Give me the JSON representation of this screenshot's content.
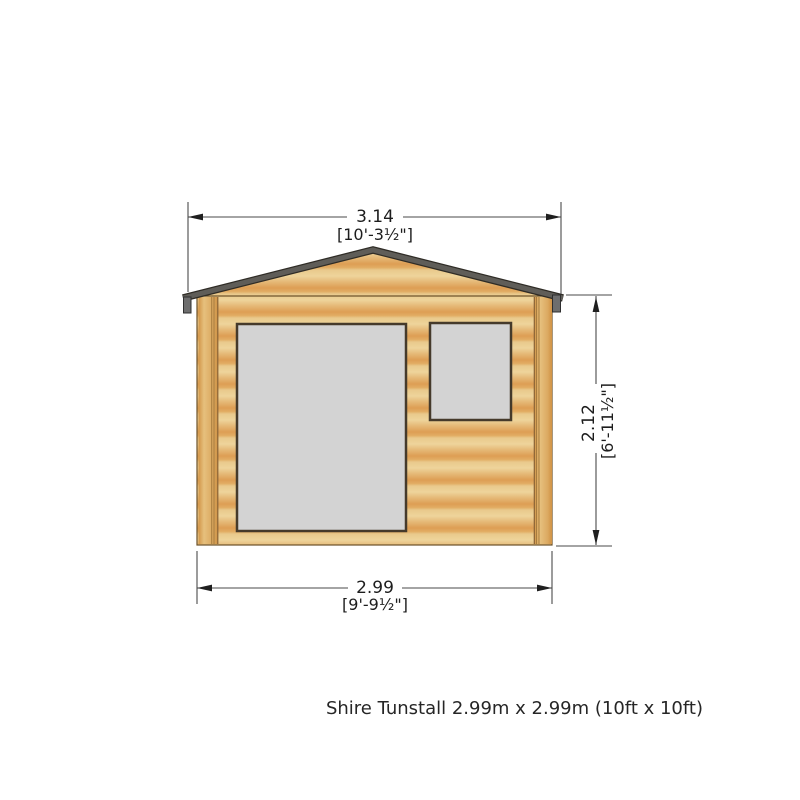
{
  "caption": "Shire Tunstall 2.99m x 2.99m (10ft x 10ft)",
  "product": {
    "name": "Shire Tunstall",
    "size_metric": "2.99m x 2.99m",
    "size_imperial": "10ft x 10ft",
    "view": "front elevation drawing",
    "features": [
      "gabled roof",
      "door",
      "window"
    ]
  },
  "dimensions": {
    "overall_width": {
      "metric": "3.14",
      "imperial": "[10'-3½\"]"
    },
    "wall_height": {
      "metric": "2.12",
      "imperial": "[6'-11½\"]"
    },
    "base_width": {
      "metric": "2.99",
      "imperial": "[9'-9½\"]"
    }
  },
  "colors": {
    "background": "#ffffff",
    "wood_light": "#eed49b",
    "wood_mid": "#e5b876",
    "wood_dark": "#dd9e54",
    "outline_brown": "#6b5128",
    "roof_grey": "#5f5d58",
    "fitting_grey": "#6e6e6e",
    "glass_grey": "#d3d3d3",
    "frame_dark": "#453a2b",
    "dimension_line": "#4a4a4a",
    "text": "#1d1d1d"
  }
}
